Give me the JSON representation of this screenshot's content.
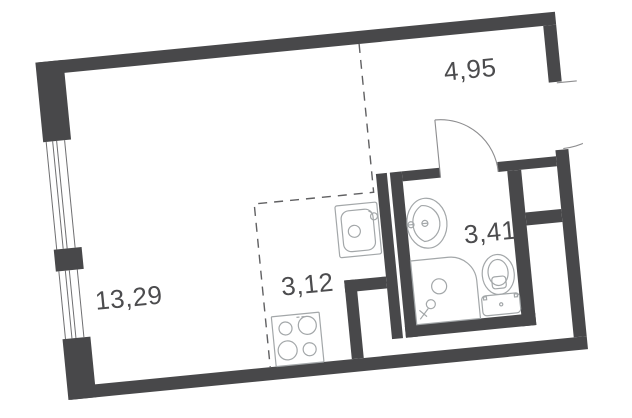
{
  "plan": {
    "title": "studio-apartment-floor-plan",
    "rooms": [
      {
        "id": "living",
        "area_label": "13,29"
      },
      {
        "id": "kitchen",
        "area_label": "3,12"
      },
      {
        "id": "hall",
        "area_label": "4,95"
      },
      {
        "id": "bathroom",
        "area_label": "3,41"
      }
    ],
    "icons": [
      "window-icon",
      "entry-door-swing-icon",
      "bathroom-door-swing-icon",
      "kitchen-sink-icon",
      "stove-icon",
      "washbasin-icon",
      "shower-icon",
      "toilet-icon"
    ],
    "colors": {
      "wall": "#48484a",
      "fixture_line": "#a3a7a9",
      "dashed_line": "#606062",
      "label_text": "#4c4c4e",
      "swing_line": "#8d8d8f",
      "background": "#ffffff"
    }
  }
}
